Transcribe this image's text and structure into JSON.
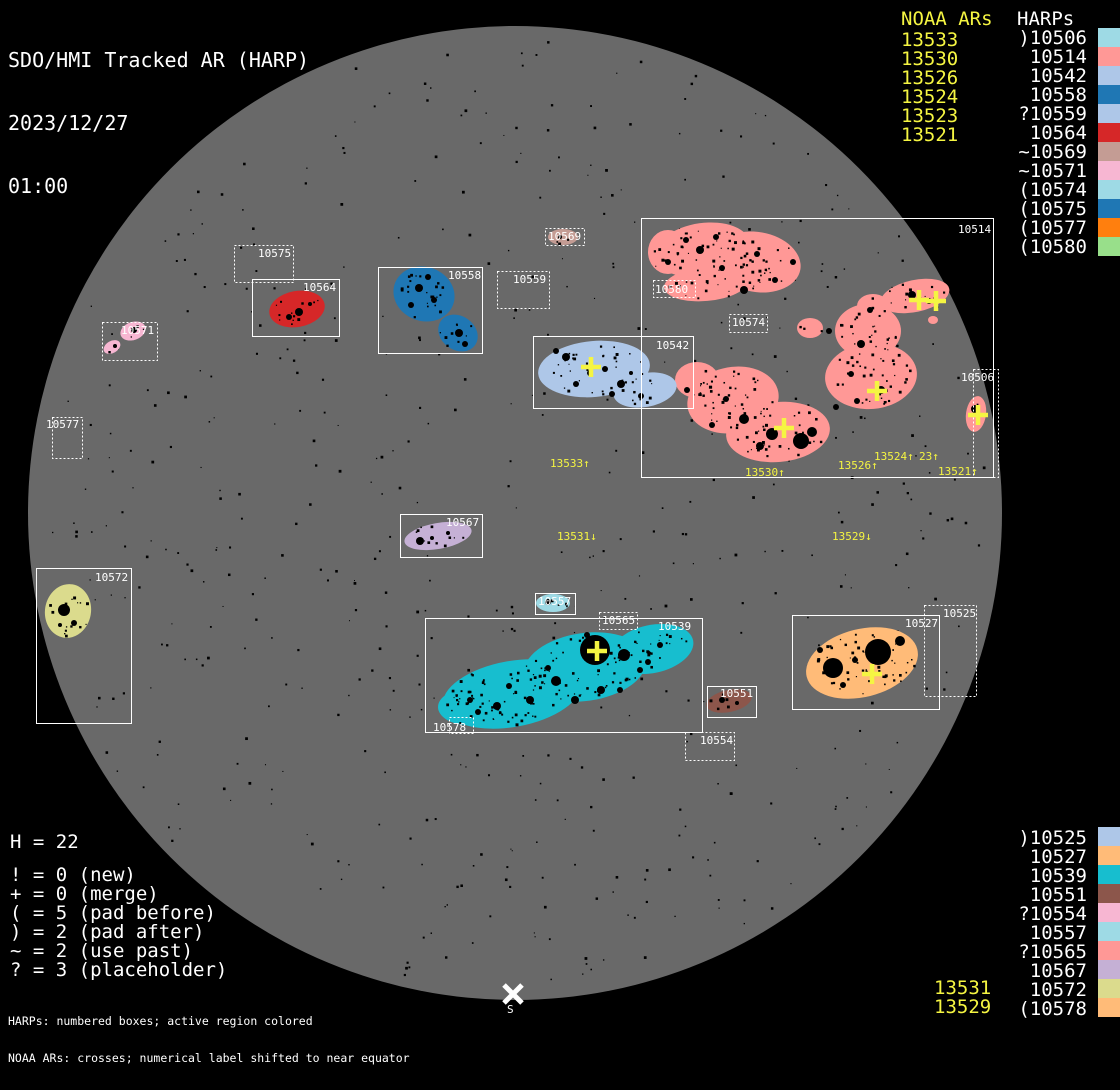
{
  "header": {
    "title": "SDO/HMI Tracked AR (HARP)",
    "date": "2023/12/27",
    "time": "01:00"
  },
  "colors": {
    "background": "#000000",
    "disk": "#696969",
    "frame": "#ffffff",
    "noaa_yellow": "#f5f542"
  },
  "legend_top_right": {
    "noaa_title": "NOAA ARs",
    "harps_title": "HARPs",
    "noaa_items": [
      "13533",
      "13530",
      "13526",
      "13524",
      "13523",
      "13521"
    ],
    "harp_items": [
      {
        "label": ")10506",
        "color": "#9edae5"
      },
      {
        "label": "10514",
        "color": "#ff9896"
      },
      {
        "label": "10542",
        "color": "#aec7e8"
      },
      {
        "label": "10558",
        "color": "#1f77b4"
      },
      {
        "label": "?10559",
        "color": "#aec7e8"
      },
      {
        "label": "10564",
        "color": "#d62728"
      },
      {
        "label": "~10569",
        "color": "#c49c94"
      },
      {
        "label": "~10571",
        "color": "#f7b6d2"
      },
      {
        "label": "(10574",
        "color": "#9edae5"
      },
      {
        "label": "(10575",
        "color": "#1f77b4"
      },
      {
        "label": "(10577",
        "color": "#ff7f0e"
      },
      {
        "label": "(10580",
        "color": "#98df8a"
      }
    ]
  },
  "legend_bottom_right": {
    "harp_items": [
      {
        "label": ")10525",
        "color": "#aec7e8"
      },
      {
        "label": "10527",
        "color": "#ffbb78"
      },
      {
        "label": "10539",
        "color": "#17becf"
      },
      {
        "label": "10551",
        "color": "#8c564b"
      },
      {
        "label": "?10554",
        "color": "#f7b6d2"
      },
      {
        "label": "10557",
        "color": "#9edae5"
      },
      {
        "label": "?10565",
        "color": "#ff9896"
      },
      {
        "label": "10567",
        "color": "#c5b0d5"
      },
      {
        "label": "10572",
        "color": "#dbdb8d"
      },
      {
        "label": "(10578",
        "color": "#ffbb78"
      }
    ],
    "noaa_items": [
      "13531",
      "13529"
    ]
  },
  "stats": {
    "count": "H = 22",
    "lines": [
      "! = 0 (new)",
      "+ = 0 (merge)",
      "( = 5 (pad before)",
      ") = 2 (pad after)",
      "~ = 2 (use past)",
      "? = 3 (placeholder)"
    ]
  },
  "footer": {
    "line1": "HARPs: numbered boxes; active region colored",
    "line2": "NOAA ARs: crosses; numerical label shifted to near equator"
  },
  "disk": {
    "cx": 515,
    "cy": 513,
    "r": 487,
    "south_marker": "S"
  },
  "regions": [
    {
      "harp": "10514",
      "box": [
        641,
        218,
        352,
        259
      ],
      "style": "solid",
      "label_pos": [
        958,
        223
      ],
      "color": "#ff9896",
      "blobs": [
        [
          703,
          250,
          48,
          27,
          -8
        ],
        [
          757,
          262,
          44,
          30,
          10
        ],
        [
          706,
          284,
          42,
          17,
          -5
        ],
        [
          668,
          252,
          20,
          22,
          0
        ],
        [
          810,
          328,
          13,
          10,
          0
        ],
        [
          868,
          331,
          33,
          27,
          0
        ],
        [
          871,
          376,
          46,
          33,
          -5
        ],
        [
          873,
          306,
          16,
          12,
          0
        ],
        [
          915,
          296,
          35,
          16,
          -12
        ],
        [
          933,
          320,
          5,
          4,
          0
        ],
        [
          733,
          400,
          46,
          33,
          -10
        ],
        [
          778,
          432,
          52,
          30,
          -5
        ],
        [
          697,
          380,
          22,
          18,
          0
        ]
      ],
      "spots": [
        [
          700,
          250,
          4
        ],
        [
          722,
          268,
          3
        ],
        [
          757,
          254,
          3
        ],
        [
          744,
          290,
          4
        ],
        [
          686,
          240,
          3
        ],
        [
          793,
          262,
          3
        ],
        [
          829,
          331,
          3
        ],
        [
          861,
          344,
          4
        ],
        [
          881,
          390,
          4
        ],
        [
          857,
          401,
          3
        ],
        [
          744,
          419,
          5
        ],
        [
          772,
          434,
          6
        ],
        [
          801,
          441,
          8
        ],
        [
          812,
          432,
          5
        ],
        [
          760,
          446,
          4
        ],
        [
          726,
          399,
          3
        ],
        [
          912,
          295,
          4
        ],
        [
          929,
          301,
          3
        ],
        [
          668,
          262,
          3
        ],
        [
          716,
          237,
          3
        ],
        [
          775,
          280,
          3
        ],
        [
          851,
          374,
          3
        ],
        [
          836,
          407,
          3
        ],
        [
          712,
          425,
          3
        ],
        [
          687,
          390,
          3
        ],
        [
          870,
          310,
          3
        ]
      ]
    },
    {
      "harp": "10506",
      "box": [
        973,
        369,
        25,
        108
      ],
      "style": "dotted",
      "label_pos": [
        961,
        371
      ],
      "color": "#ff9896",
      "blobs": [
        [
          976,
          414,
          10,
          18,
          8
        ]
      ],
      "spots": [
        [
          975,
          409,
          4
        ]
      ]
    },
    {
      "harp": "10525",
      "box": [
        924,
        605,
        52,
        91
      ],
      "style": "dotted",
      "label_pos": [
        943,
        607
      ],
      "color": "#aec7e8",
      "blobs": [],
      "spots": []
    },
    {
      "harp": "10527",
      "box": [
        792,
        615,
        147,
        94
      ],
      "style": "solid",
      "label_pos": [
        905,
        617
      ],
      "color": "#ffbb78",
      "blobs": [
        [
          862,
          663,
          57,
          34,
          -14
        ]
      ],
      "spots": [
        [
          833,
          668,
          10
        ],
        [
          878,
          652,
          13
        ],
        [
          900,
          641,
          5
        ],
        [
          855,
          660,
          3
        ],
        [
          843,
          685,
          3
        ],
        [
          820,
          650,
          3
        ]
      ]
    },
    {
      "harp": "10539",
      "box": [
        425,
        618,
        277,
        114
      ],
      "style": "solid",
      "label_pos": [
        658,
        620
      ],
      "color": "#17becf",
      "blobs": [
        [
          512,
          694,
          70,
          33,
          -10
        ],
        [
          585,
          667,
          62,
          34,
          -8
        ],
        [
          652,
          649,
          42,
          24,
          -12
        ],
        [
          468,
          707,
          30,
          18,
          0
        ]
      ],
      "spots": [
        [
          595,
          650,
          15
        ],
        [
          624,
          655,
          6
        ],
        [
          556,
          681,
          5
        ],
        [
          601,
          690,
          4
        ],
        [
          530,
          700,
          4
        ],
        [
          497,
          706,
          4
        ],
        [
          478,
          712,
          3
        ],
        [
          548,
          668,
          3
        ],
        [
          575,
          700,
          4
        ],
        [
          640,
          670,
          3
        ],
        [
          660,
          645,
          3
        ],
        [
          509,
          686,
          3
        ],
        [
          470,
          700,
          3
        ],
        [
          620,
          690,
          3
        ],
        [
          648,
          662,
          3
        ],
        [
          587,
          635,
          3
        ]
      ]
    },
    {
      "harp": "10542",
      "box": [
        533,
        336,
        160,
        72
      ],
      "style": "solid",
      "label_pos": [
        656,
        339
      ],
      "color": "#aec7e8",
      "blobs": [
        [
          594,
          369,
          56,
          28,
          -5
        ],
        [
          645,
          390,
          32,
          17,
          -10
        ]
      ],
      "spots": [
        [
          566,
          357,
          4
        ],
        [
          605,
          369,
          3
        ],
        [
          576,
          384,
          3
        ],
        [
          621,
          384,
          4
        ],
        [
          641,
          396,
          3
        ],
        [
          556,
          351,
          3
        ],
        [
          590,
          373,
          3
        ],
        [
          612,
          394,
          3
        ],
        [
          631,
          373,
          2
        ]
      ]
    },
    {
      "harp": "10551",
      "box": [
        707,
        686,
        49,
        31
      ],
      "style": "solid",
      "label_pos": [
        720,
        687
      ],
      "color": "#8c564b",
      "blobs": [
        [
          729,
          701,
          23,
          11,
          -12
        ]
      ],
      "spots": [
        [
          722,
          700,
          3
        ],
        [
          737,
          703,
          2
        ]
      ]
    },
    {
      "harp": "10554",
      "box": [
        685,
        732,
        49,
        28
      ],
      "style": "dotted",
      "label_pos": [
        700,
        734
      ],
      "color": "#f7b6d2",
      "blobs": [],
      "spots": []
    },
    {
      "harp": "10557",
      "box": [
        535,
        593,
        40,
        21
      ],
      "style": "solid",
      "label_pos": [
        538,
        595
      ],
      "color": "#9edae5",
      "blobs": [
        [
          553,
          603,
          17,
          9,
          0
        ]
      ],
      "spots": [
        [
          548,
          602,
          3
        ]
      ]
    },
    {
      "harp": "10558",
      "box": [
        378,
        267,
        104,
        86
      ],
      "style": "solid",
      "label_pos": [
        448,
        269
      ],
      "color": "#1f77b4",
      "blobs": [
        [
          424,
          294,
          31,
          27,
          20
        ],
        [
          458,
          333,
          21,
          17,
          35
        ]
      ],
      "spots": [
        [
          419,
          288,
          4
        ],
        [
          434,
          300,
          3
        ],
        [
          459,
          333,
          4
        ],
        [
          465,
          344,
          3
        ],
        [
          411,
          305,
          3
        ],
        [
          428,
          277,
          3
        ]
      ]
    },
    {
      "harp": "10559",
      "box": [
        497,
        271,
        52,
        37
      ],
      "style": "dotted",
      "label_pos": [
        513,
        273
      ],
      "color": "#aec7e8",
      "blobs": [],
      "spots": []
    },
    {
      "harp": "10564",
      "box": [
        252,
        279,
        87,
        57
      ],
      "style": "solid",
      "label_pos": [
        303,
        281
      ],
      "color": "#d62728",
      "blobs": [
        [
          297,
          309,
          28,
          18,
          -10
        ]
      ],
      "spots": [
        [
          299,
          312,
          4
        ],
        [
          289,
          317,
          3
        ],
        [
          310,
          304,
          2
        ]
      ]
    },
    {
      "harp": "10565",
      "box": [
        599,
        612,
        38,
        17
      ],
      "style": "dotted",
      "label_pos": [
        602,
        614
      ],
      "color": "#ff9896",
      "blobs": [],
      "spots": []
    },
    {
      "harp": "10567",
      "box": [
        400,
        514,
        82,
        43
      ],
      "style": "solid",
      "label_pos": [
        446,
        516
      ],
      "color": "#c5b0d5",
      "blobs": [
        [
          438,
          536,
          34,
          13,
          -10
        ]
      ],
      "spots": [
        [
          420,
          541,
          4
        ],
        [
          448,
          533,
          2
        ],
        [
          432,
          538,
          2
        ]
      ]
    },
    {
      "harp": "10569",
      "box": [
        545,
        228,
        39,
        17
      ],
      "style": "dotted",
      "label_pos": [
        548,
        230
      ],
      "color": "#c49c94",
      "blobs": [
        [
          563,
          237,
          15,
          8,
          0
        ]
      ],
      "spots": [
        [
          560,
          237,
          2
        ]
      ]
    },
    {
      "harp": "10571",
      "box": [
        102,
        322,
        55,
        38
      ],
      "style": "dotted",
      "label_pos": [
        121,
        324
      ],
      "color": "#f7b6d2",
      "blobs": [
        [
          133,
          331,
          13,
          9,
          -20
        ],
        [
          112,
          347,
          9,
          6,
          -30
        ]
      ],
      "spots": [
        [
          134,
          330,
          3
        ],
        [
          115,
          346,
          2
        ]
      ]
    },
    {
      "harp": "10572",
      "box": [
        36,
        568,
        95,
        155
      ],
      "style": "solid",
      "label_pos": [
        95,
        571
      ],
      "color": "#dbdb8d",
      "blobs": [
        [
          68,
          611,
          23,
          27,
          10
        ]
      ],
      "spots": [
        [
          64,
          610,
          6
        ],
        [
          74,
          623,
          3
        ],
        [
          60,
          625,
          2
        ]
      ]
    },
    {
      "harp": "10574",
      "box": [
        729,
        314,
        38,
        18
      ],
      "style": "dotted",
      "label_pos": [
        732,
        316
      ],
      "color": "#9edae5",
      "blobs": [],
      "spots": []
    },
    {
      "harp": "10575",
      "box": [
        234,
        245,
        59,
        37
      ],
      "style": "dotted",
      "label_pos": [
        258,
        247
      ],
      "color": "#1f77b4",
      "blobs": [],
      "spots": []
    },
    {
      "harp": "10577",
      "box": [
        52,
        417,
        30,
        41
      ],
      "style": "dotted",
      "label_pos": [
        46,
        418
      ],
      "color": "#ff7f0e",
      "blobs": [],
      "spots": []
    },
    {
      "harp": "10578",
      "box": [
        449,
        717,
        24,
        16
      ],
      "style": "dotted",
      "label_pos": [
        433,
        721
      ],
      "color": "#ffbb78",
      "blobs": [],
      "spots": []
    },
    {
      "harp": "10580",
      "box": [
        653,
        280,
        42,
        17
      ],
      "style": "dotted",
      "label_pos": [
        655,
        283
      ],
      "color": "#98df8a",
      "blobs": [],
      "spots": []
    }
  ],
  "crosses": [
    [
      919,
      300
    ],
    [
      936,
      301
    ],
    [
      877,
      391
    ],
    [
      784,
      428
    ],
    [
      978,
      415
    ],
    [
      591,
      367
    ],
    [
      597,
      651
    ],
    [
      872,
      674
    ]
  ],
  "noaa_disk_labels": [
    {
      "text": "13533↑",
      "x": 550,
      "y": 457
    },
    {
      "text": "13530↑",
      "x": 745,
      "y": 466
    },
    {
      "text": "13526↑",
      "x": 838,
      "y": 459
    },
    {
      "text": "13524↑",
      "x": 874,
      "y": 450
    },
    {
      "text": "23↑",
      "x": 919,
      "y": 450
    },
    {
      "text": "13521↑",
      "x": 938,
      "y": 465
    },
    {
      "text": "13531↓",
      "x": 557,
      "y": 530
    },
    {
      "text": "13529↓",
      "x": 832,
      "y": 530
    }
  ]
}
